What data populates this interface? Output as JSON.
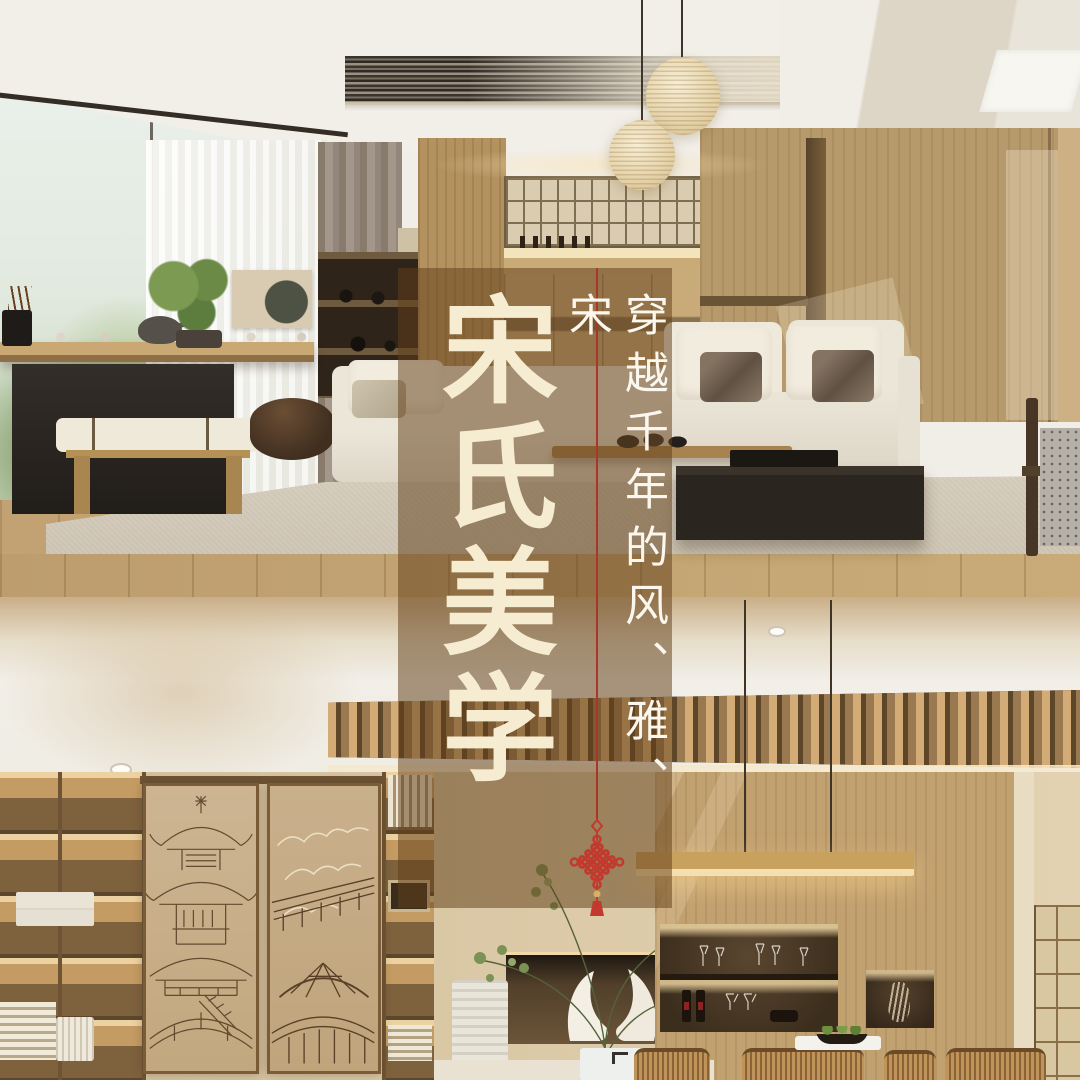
{
  "poster": {
    "headline": "宋氏美学",
    "tagline": "穿越千年的风、雅、宋",
    "ornament": "chinese-knot",
    "colors": {
      "overlay_brown": "rgba(97,63,24,0.52)",
      "headline_ivory": "#f6ecd2",
      "tagline_white": "#fbf7ee",
      "accent_red": "#ab352a",
      "knot_red": "#c23a2e",
      "bead_gold": "#d9af63"
    }
  }
}
